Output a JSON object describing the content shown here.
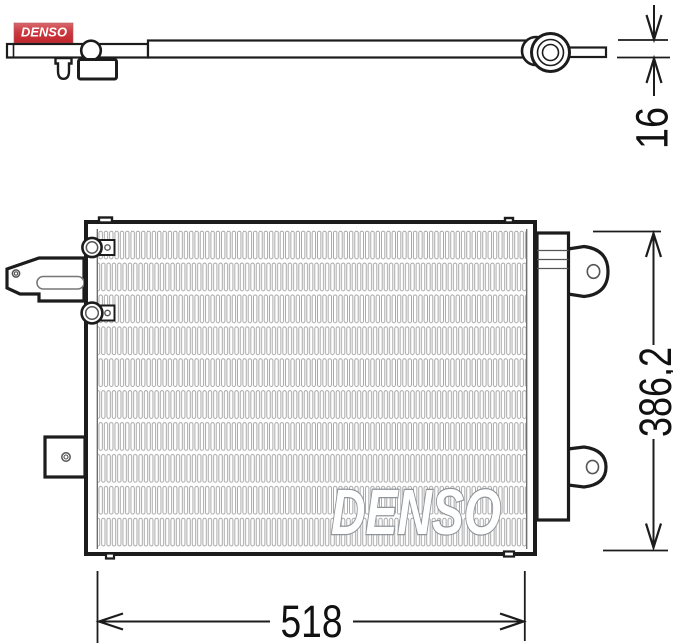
{
  "logo": {
    "text": "DENSO"
  },
  "watermark": {
    "text": "DENSO"
  },
  "dimensions": {
    "depth": {
      "value": "16"
    },
    "height": {
      "value": "386,2"
    },
    "width": {
      "value": "518"
    }
  },
  "colors": {
    "line": "#1c1c1c",
    "fin_outline": "#9b9b9b",
    "watermark_outline": "#8f9499",
    "logo_red": "#c0252c",
    "logo_red_light": "#d9686c",
    "dimension_text": "#111111"
  }
}
